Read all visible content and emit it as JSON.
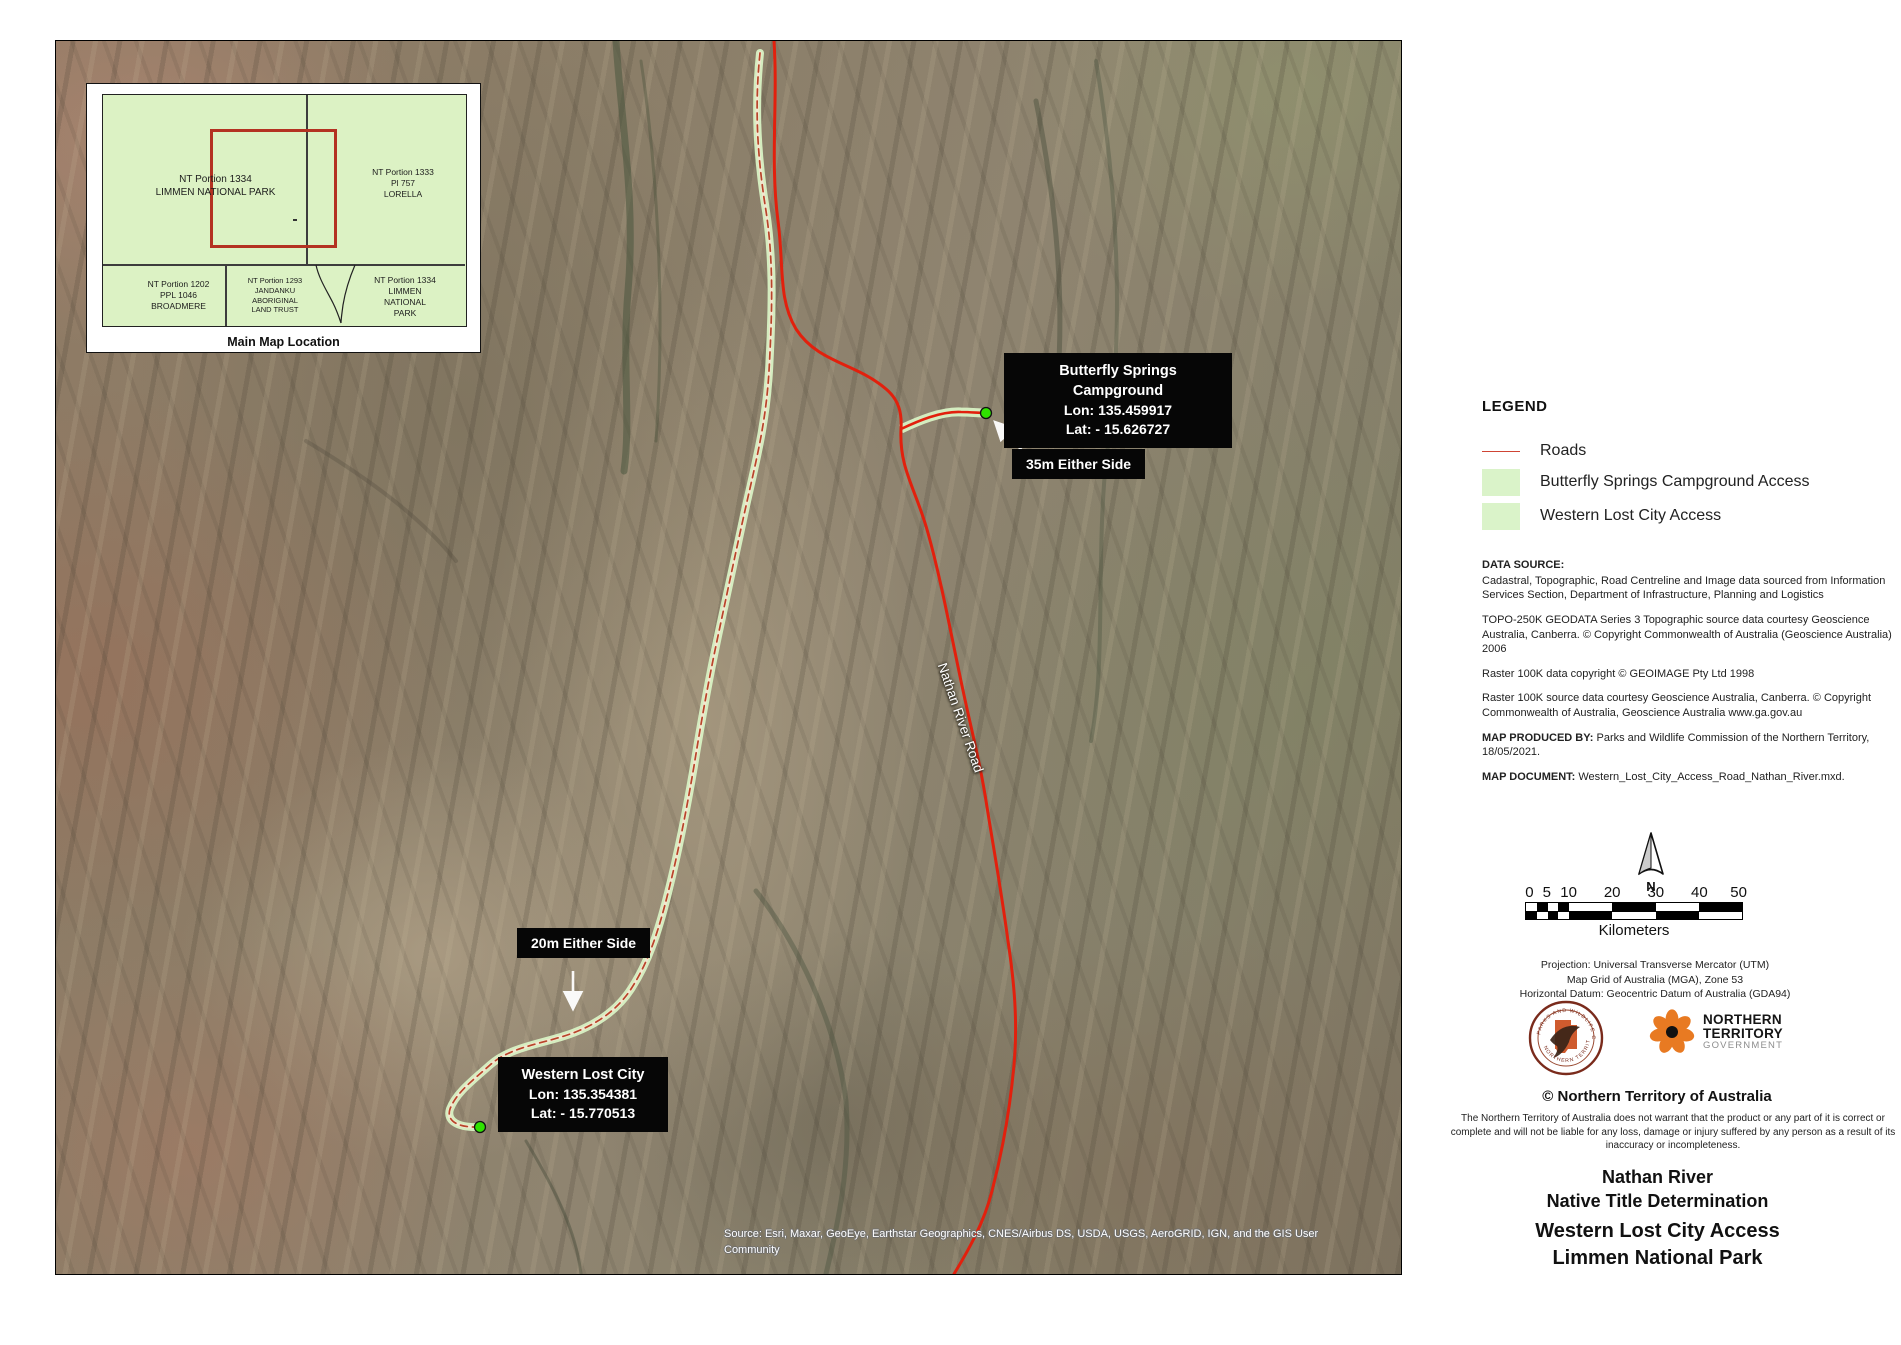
{
  "map": {
    "road_label": "Nathan River Road",
    "attribution": "Source: Esri, Maxar, GeoEye, Earthstar Geographics, CNES/Airbus DS, USDA, USGS, AeroGRID, IGN, and the GIS User Community"
  },
  "inset": {
    "caption": "Main Map Location",
    "cells": {
      "top_left": "NT Portion 1334\nLIMMEN NATIONAL PARK",
      "top_right": "NT Portion 1333\nPl 757\nLORELLA",
      "bottom_left": "NT Portion 1202\nPPL 1046\nBROADMERE",
      "bottom_middle": "NT Portion 1293\nJANDANKU\nABORIGINAL\nLAND TRUST",
      "bottom_right": "NT Portion 1334\nLIMMEN\nNATIONAL\nPARK"
    }
  },
  "callouts": {
    "butterfly": {
      "title": "Butterfly Springs Campground",
      "lon": "Lon: 135.459917",
      "lat": "Lat: - 15.626727",
      "buffer_label": "35m Either Side"
    },
    "western": {
      "title": "Western Lost City",
      "lon": "Lon: 135.354381",
      "lat": "Lat: - 15.770513",
      "buffer_label": "20m Either Side"
    }
  },
  "legend": {
    "title": "LEGEND",
    "items": [
      {
        "label": "Roads",
        "color": "#cf4434"
      },
      {
        "label": "Butterfly Springs Campground Access",
        "color": "#daf3c9"
      },
      {
        "label": "Western Lost City Access",
        "color": "#daf3c9"
      }
    ]
  },
  "data_source": {
    "heading": "DATA SOURCE:",
    "p1": "Cadastral, Topographic, Road Centreline and Image data sourced from Information Services Section, Department of Infrastructure, Planning and Logistics",
    "p2": "TOPO-250K GEODATA Series 3 Topographic source data courtesy Geoscience Australia, Canberra.  © Copyright Commonwealth of Australia  (Geoscience Australia) 2006",
    "p3": "Raster 100K data copyright © GEOIMAGE Pty Ltd 1998",
    "p4": "Raster 100K source data courtesy Geoscience Australia, Canberra. © Copyright Commonwealth of Australia, Geoscience Australia www.ga.gov.au",
    "produced_label": "MAP PRODUCED BY:",
    "produced_text": " Parks and Wildlife Commission of the Northern Territory, 18/05/2021.",
    "document_label": "MAP DOCUMENT:",
    "document_text": " Western_Lost_City_Access_Road_Nathan_River.mxd."
  },
  "compass": {
    "north_label": "N"
  },
  "scalebar": {
    "ticks": [
      "0",
      "5",
      "10",
      "20",
      "30",
      "40",
      "50"
    ],
    "unit": "Kilometers"
  },
  "projection": {
    "line1": "Projection:  Universal Transverse Mercator (UTM)",
    "line2": "Map Grid of Australia (MGA), Zone 53",
    "line3": "Horizontal Datum:  Geocentric Datum of Australia (GDA94)"
  },
  "logos": {
    "parks_ring_top": "PARKS AND WILDLIFE COMMISSION",
    "parks_ring_bottom": "NORTHERN TERRITORY",
    "ntgov_line1": "NORTHERN",
    "ntgov_line2": "TERRITORY",
    "ntgov_line3": "GOVERNMENT"
  },
  "footer": {
    "copyright": "©  Northern Territory of Australia",
    "disclaimer": "The Northern Territory of Australia does not warrant that the product or any part of it is correct or complete and will not be liable for any loss, damage or injury suffered by any person as a result of its inaccuracy or incompleteness.",
    "title_line1": "Nathan River",
    "title_line2": "Native Title Determination",
    "title_line3": "Western Lost City Access",
    "title_line4": "Limmen National Park"
  }
}
